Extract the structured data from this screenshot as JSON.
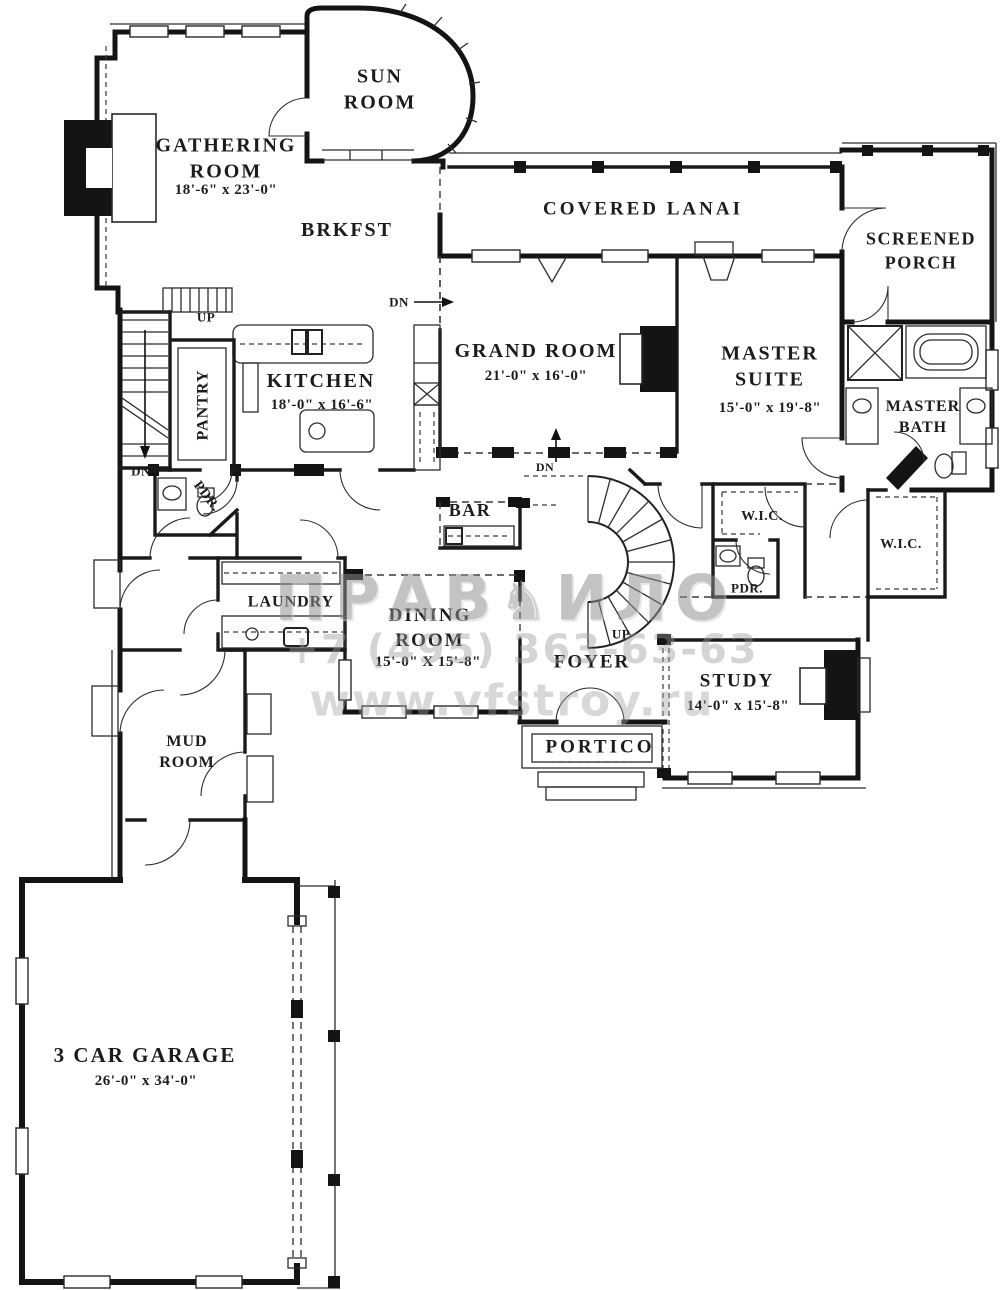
{
  "plan": {
    "rooms": {
      "sun_room": {
        "name": "SUN\nROOM"
      },
      "gathering": {
        "name": "GATHERING\nROOM",
        "dims": "18'-6\" x 23'-0\""
      },
      "brkfst": {
        "name": "BRKFST"
      },
      "covered_lanai": {
        "name": "COVERED LANAI"
      },
      "screened_porch": {
        "name": "SCREENED\nPORCH"
      },
      "grand_room": {
        "name": "GRAND ROOM",
        "dims": "21'-0\" x 16'-0\""
      },
      "master_suite": {
        "name": "MASTER\nSUITE",
        "dims": "15'-0\" x 19'-8\""
      },
      "master_bath": {
        "name": "MASTER\nBATH"
      },
      "kitchen": {
        "name": "KITCHEN",
        "dims": "18'-0\" x 16'-6\""
      },
      "pantry": {
        "name": "PANTRY"
      },
      "powder1": {
        "name": "PDR."
      },
      "bar": {
        "name": "BAR"
      },
      "wic1": {
        "name": "W.I.C."
      },
      "wic2": {
        "name": "W.I.C."
      },
      "powder2": {
        "name": "PDR."
      },
      "laundry": {
        "name": "LAUNDRY"
      },
      "dining": {
        "name": "DINING\nROOM",
        "dims": "15'-0\" X 15'-8\""
      },
      "foyer": {
        "name": "FOYER"
      },
      "study": {
        "name": "STUDY",
        "dims": "14'-0\" x 15'-8\""
      },
      "portico": {
        "name": "PORTICO"
      },
      "mud_room": {
        "name": "MUD\nROOM"
      },
      "garage": {
        "name": "3 CAR GARAGE",
        "dims": "26'-0\" x 34'-0\""
      }
    },
    "markers": {
      "up_stairs": "UP",
      "dn_stairs": "DN",
      "dn_kitchen": "DN",
      "dn_grand": "DN",
      "up_curved": "UP"
    }
  },
  "watermark": {
    "logo_left": "ПРАВ",
    "logo_right": "ИЛО",
    "phone": "+7 (495) 363-63-63",
    "website": "www.vfstroy.ru"
  }
}
